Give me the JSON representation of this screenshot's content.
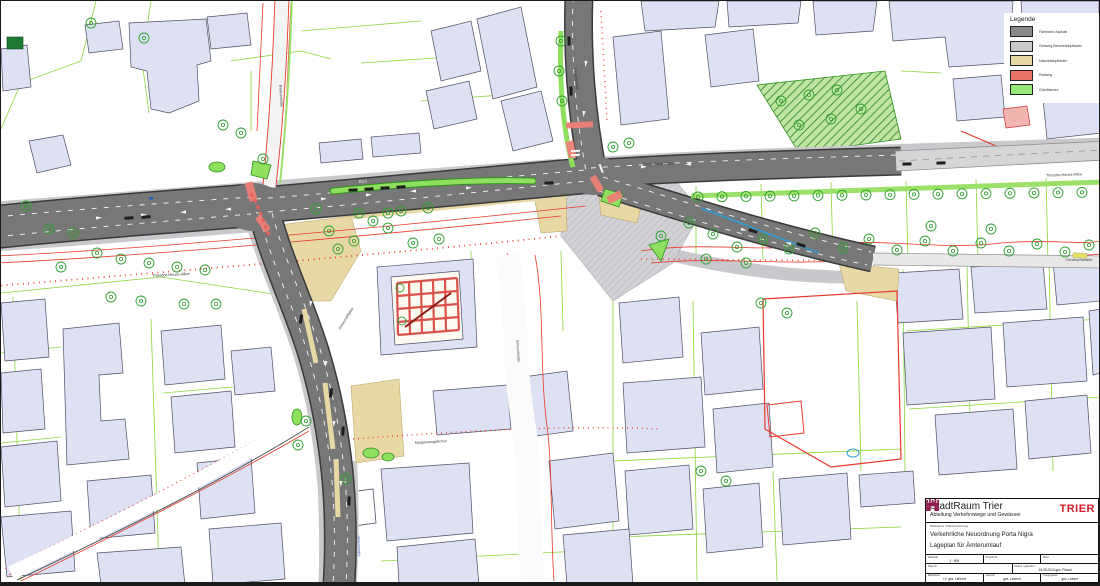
{
  "legend": {
    "title": "Legende",
    "items": [
      {
        "label": "Fahrbahn Asphalt",
        "color": "#8a8a8a"
      },
      {
        "label": "Gehweg Betonsteinpflaster",
        "color": "#c9c9c9"
      },
      {
        "label": "Natursteinpflaster",
        "color": "#e8d9a8"
      },
      {
        "label": "Radweg",
        "color": "#e8736b"
      },
      {
        "label": "Grünflächen",
        "color": "#97e87a"
      }
    ]
  },
  "title_block": {
    "org": "StadtRaum Trier",
    "dept": "Abteilung Verkehrswege und Gewässer",
    "logo_text": "TRIER",
    "section_label": "Maßnahme / Planbezeichnung",
    "project": "Verkehrliche Neuordnung Porta Nigra",
    "plan": "Lageplan für Ämterumlauf",
    "rows": [
      [
        {
          "label": "Maßstab",
          "value": "1 : 500"
        },
        {
          "label": "Projekt-Nr.",
          "value": ""
        },
        {
          "label": "Blatt",
          "value": ""
        }
      ],
      [
        {
          "label": "Plan-Nr.",
          "value": ""
        },
        {
          "label": "Datum / geändert",
          "value": "15.08.2024 gez. Flesch"
        }
      ],
      [
        {
          "label": "Bearbeitet",
          "value": "i.V. gez. Lehnert"
        },
        {
          "label": "Geprüft",
          "value": "gez. Lehnert"
        },
        {
          "label": "Freigegeben",
          "value": "gez. Lesser"
        }
      ]
    ]
  },
  "map": {
    "street_labels": [
      {
        "text": "Theodor-Heuss-Allee",
        "x": 170,
        "y": 275,
        "rot": -3,
        "size": 4,
        "color": "#3a3a3a"
      },
      {
        "text": "Theodor-Heuss-Allee",
        "x": 1063,
        "y": 175,
        "rot": -2,
        "size": 3.8,
        "color": "#3a3a3a"
      },
      {
        "text": "Christophstraße",
        "x": 1078,
        "y": 260,
        "rot": 0,
        "size": 3.8,
        "color": "#3a3a3a"
      },
      {
        "text": "Porta-Nigra-Platz",
        "x": 657,
        "y": 164,
        "rot": -2,
        "size": 4,
        "color": "#3a3a3a"
      },
      {
        "text": "Paulinstraße",
        "x": 574,
        "y": 78,
        "rot": 83,
        "size": 4,
        "color": "#3a3a3a"
      },
      {
        "text": "Balduinstraße",
        "x": 279,
        "y": 95,
        "rot": 87,
        "size": 3.6,
        "color": "#3a3a3a"
      },
      {
        "text": "Simeonstiftplatz",
        "x": 346,
        "y": 318,
        "rot": -58,
        "size": 3.6,
        "color": "#3a3a3a"
      },
      {
        "text": "Margaretengäßchen",
        "x": 430,
        "y": 442,
        "rot": -3,
        "size": 3.6,
        "color": "#3a3a3a"
      },
      {
        "text": "Simeonstraße",
        "x": 516,
        "y": 350,
        "rot": 86,
        "size": 3.6,
        "color": "#3a3a3a"
      },
      {
        "text": "Simeonstraße",
        "x": 357,
        "y": 545,
        "rot": 88,
        "size": 3.4,
        "color": "#3355bb"
      }
    ],
    "road_marking": "BUS",
    "colors": {
      "asphalt_new": "#777777",
      "asphalt_existing": "#d6d6d6",
      "sidewalk": "#c9c9cd",
      "naturstein": "#e7d8a6",
      "radweg": "#ee8078",
      "gruen": "#8fe05f",
      "building": "#dde1f3",
      "parcel_line": "#85d42f",
      "red_line": "#e8382b",
      "tree_ring": "#2fa12f"
    }
  }
}
